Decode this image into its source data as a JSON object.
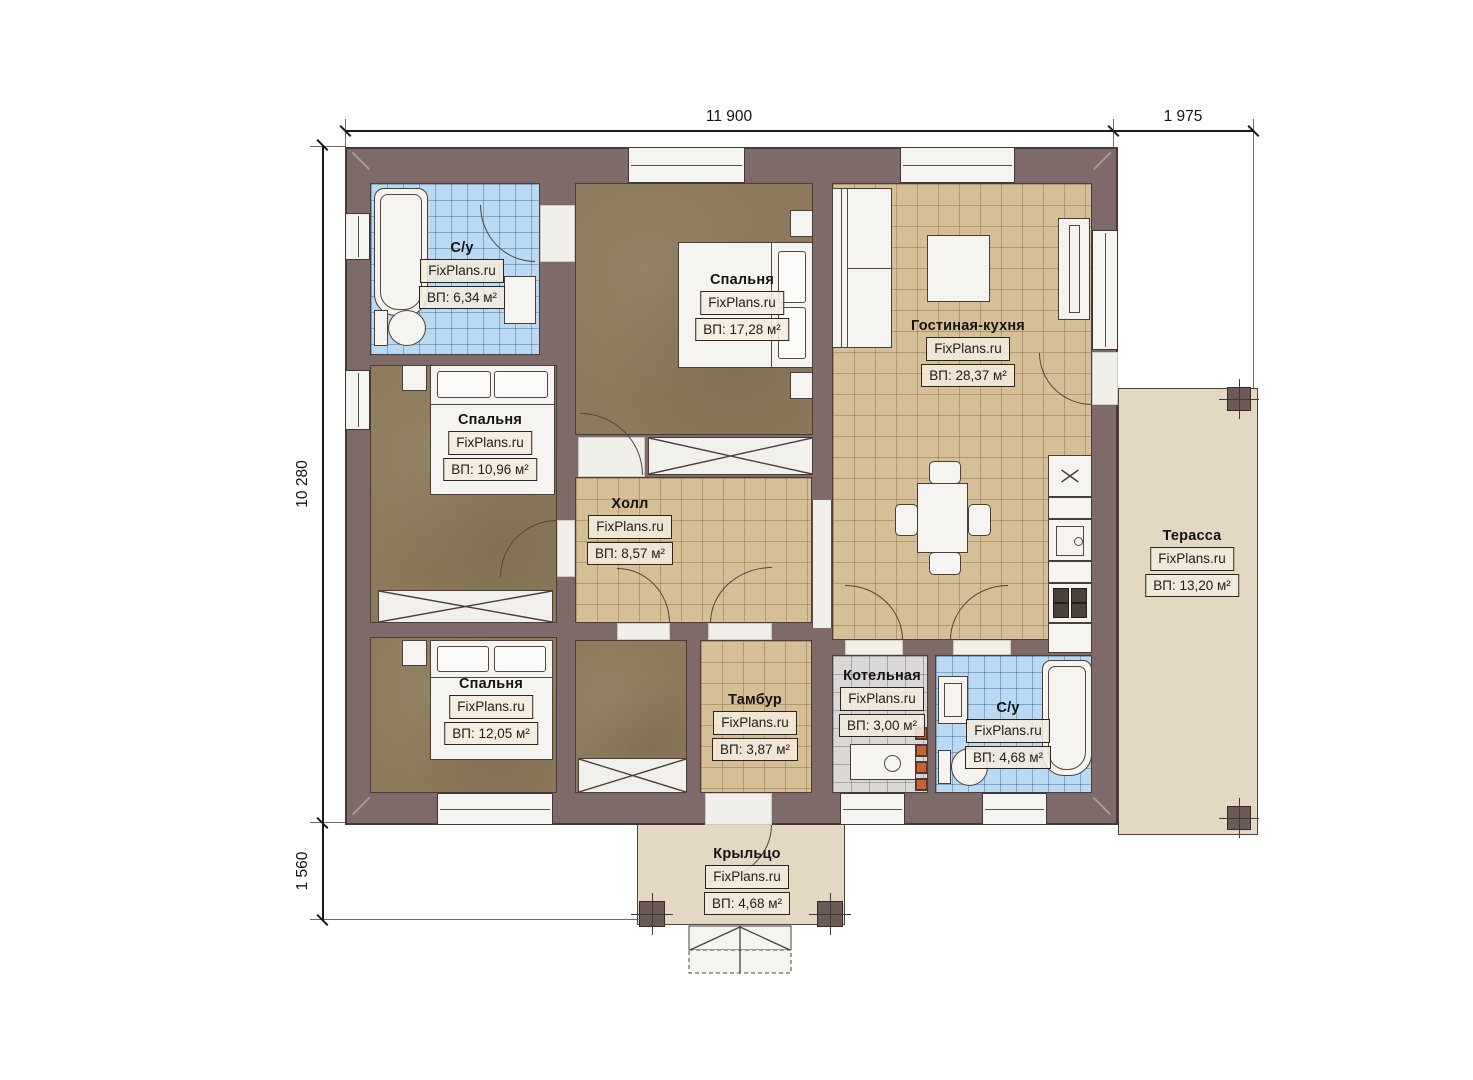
{
  "watermark": "FixPlans.ru",
  "dimensions": {
    "top_main": "11 900",
    "top_right": "1 975",
    "left_main": "10 280",
    "left_bottom": "1 560"
  },
  "rooms": [
    {
      "key": "bathroom-top",
      "name": "С/у",
      "area": "ВП: 6,34 м²"
    },
    {
      "key": "bedroom-top",
      "name": "Спальня",
      "area": "ВП: 17,28 м²"
    },
    {
      "key": "living-kitchen",
      "name": "Гостиная-кухня",
      "area": "ВП: 28,37 м²"
    },
    {
      "key": "bedroom-middle",
      "name": "Спальня",
      "area": "ВП: 10,96 м²"
    },
    {
      "key": "hall",
      "name": "Холл",
      "area": "ВП: 8,57 м²"
    },
    {
      "key": "terrace",
      "name": "Терасса",
      "area": "ВП: 13,20 м²"
    },
    {
      "key": "bedroom-bottom",
      "name": "Спальня",
      "area": "ВП: 12,05 м²"
    },
    {
      "key": "vestibule",
      "name": "Тамбур",
      "area": "ВП: 3,87 м²"
    },
    {
      "key": "boiler-room",
      "name": "Котельная",
      "area": "ВП: 3,00 м²"
    },
    {
      "key": "bathroom-bottom",
      "name": "С/у",
      "area": "ВП: 4,68 м²"
    },
    {
      "key": "porch",
      "name": "Крыльцо",
      "area": "ВП: 4,68 м²"
    }
  ],
  "colors": {
    "wall": "#7e6a69",
    "floor_wood": "#8d7a5c",
    "tile_beige": "#d5bf97",
    "tile_blue": "#b9daf2",
    "tile_gray": "#d9d8d6",
    "outdoor": "#e4d8c3",
    "chimney_accent": "#c96230"
  }
}
